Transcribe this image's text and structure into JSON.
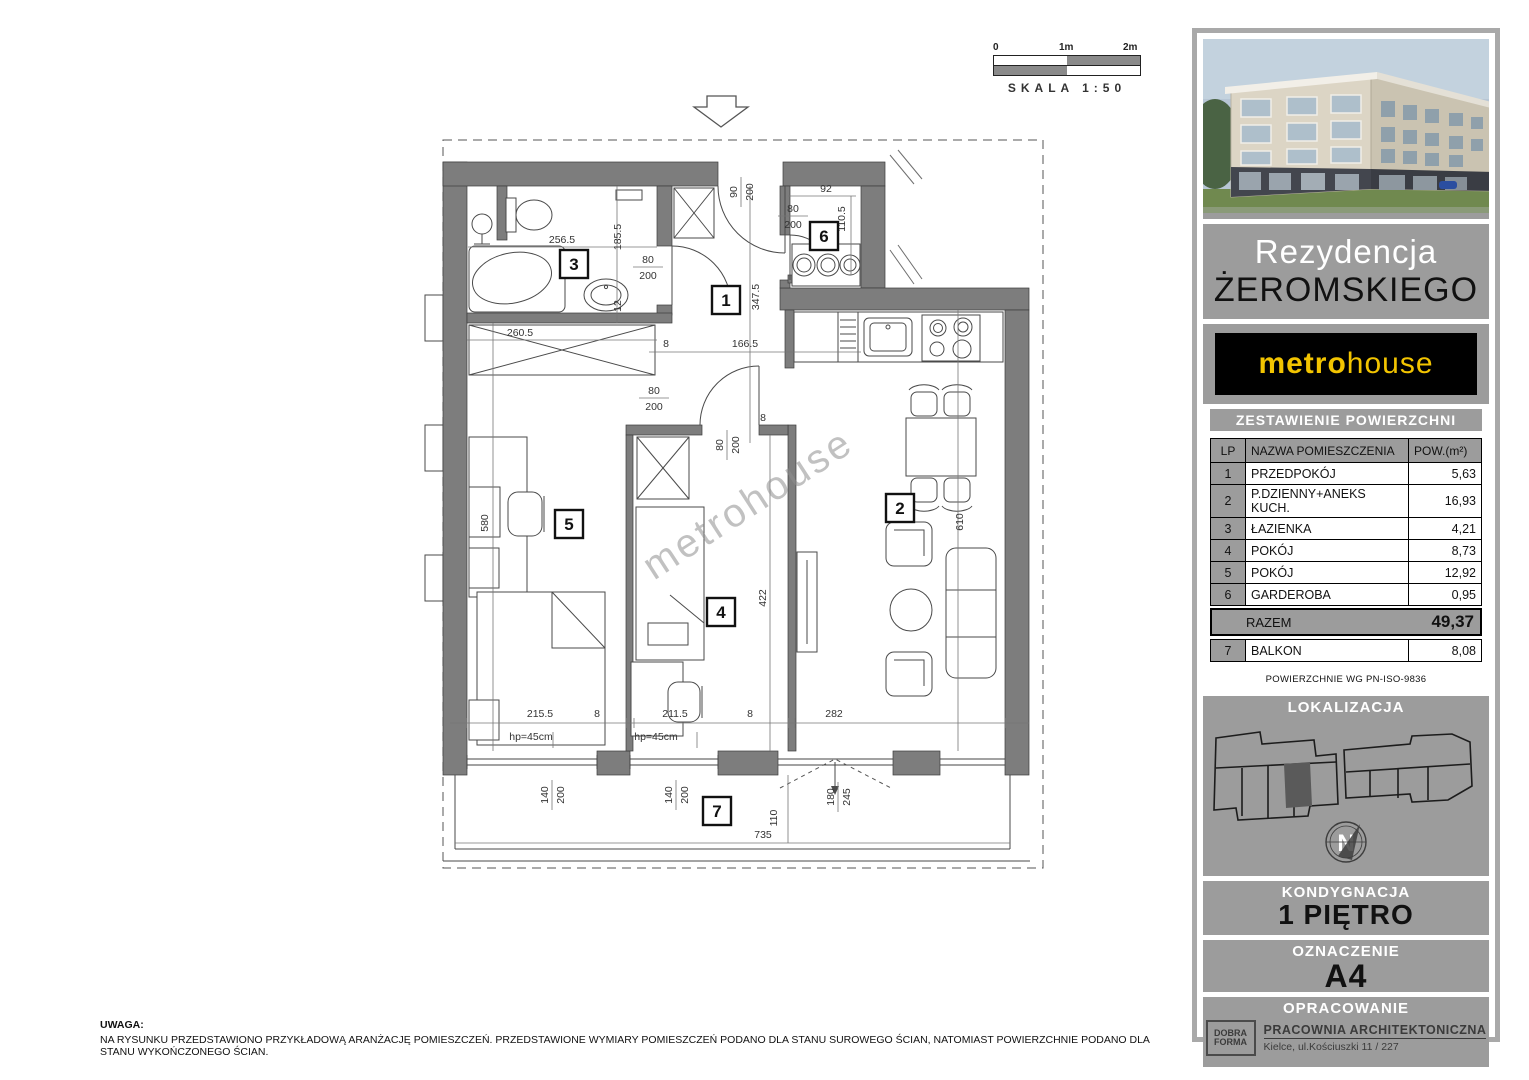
{
  "scale_bar": {
    "label_0": "0",
    "label_1": "1m",
    "label_2": "2m",
    "caption": "SKALA 1:50"
  },
  "watermark": "metrohouse",
  "note": {
    "title": "UWAGA:",
    "body": "NA RYSUNKU PRZEDSTAWIONO PRZYKŁADOWĄ ARANŻACJĘ POMIESZCZEŃ. PRZEDSTAWIONE WYMIARY POMIESZCZEŃ PODANO DLA STANU SUROWEGO ŚCIAN, NATOMIAST POWIERZCHNIE PODANO DLA STANU WYKOŃCZONEGO ŚCIAN."
  },
  "sidebar": {
    "project": {
      "line1": "Rezydencja",
      "line2": "ŻEROMSKIEGO"
    },
    "brand": {
      "part1": "metro",
      "part2": "house"
    },
    "areas_table": {
      "title": "ZESTAWIENIE POWIERZCHNI",
      "headers": [
        "LP",
        "NAZWA POMIESZCZENIA",
        "POW.(m²)"
      ],
      "rows": [
        [
          "1",
          "PRZEDPOKÓJ",
          "5,63"
        ],
        [
          "2",
          "P.DZIENNY+ANEKS KUCH.",
          "16,93"
        ],
        [
          "3",
          "ŁAZIENKA",
          "4,21"
        ],
        [
          "4",
          "POKÓJ",
          "8,73"
        ],
        [
          "5",
          "POKÓJ",
          "12,92"
        ],
        [
          "6",
          "GARDEROBA",
          "0,95"
        ]
      ],
      "total_label": "RAZEM",
      "total_value": "49,37",
      "balkon_row": {
        "lp": "7",
        "name": "BALKON",
        "value": "8,08"
      },
      "footnote": "POWIERZCHNIE WG PN-ISO-9836"
    },
    "location": {
      "title": "LOKALIZACJA",
      "compass_letter": "N"
    },
    "floor": {
      "title": "KONDYGNACJA",
      "value": "1 PIĘTRO"
    },
    "unit": {
      "title": "OZNACZENIE",
      "value": "A4"
    },
    "author": {
      "title": "OPRACOWANIE",
      "logo_line1": "DOBRA",
      "logo_line2": "FORMA",
      "studio": "PRACOWNIA ARCHITEKTONICZNA",
      "address": "Kielce,   ul.Kościuszki 11 / 227"
    }
  },
  "plan": {
    "rooms": [
      {
        "n": "1",
        "x": 726,
        "y": 300
      },
      {
        "n": "2",
        "x": 900,
        "y": 508
      },
      {
        "n": "3",
        "x": 574,
        "y": 264
      },
      {
        "n": "4",
        "x": 721,
        "y": 612
      },
      {
        "n": "5",
        "x": 569,
        "y": 524
      },
      {
        "n": "6",
        "x": 824,
        "y": 236
      },
      {
        "n": "7",
        "x": 717,
        "y": 811
      }
    ],
    "dimensions": [
      {
        "t": "256.5",
        "x": 562,
        "y": 243
      },
      {
        "t": "185.5",
        "x": 621,
        "y": 237,
        "r": -90
      },
      {
        "t": "12",
        "x": 621,
        "y": 306,
        "r": -90
      },
      {
        "t": "260.5",
        "x": 520,
        "y": 336
      },
      {
        "t": "580",
        "x": 488,
        "y": 523,
        "r": -90
      },
      {
        "t": "347.5",
        "x": 759,
        "y": 297,
        "r": -90
      },
      {
        "t": "8",
        "x": 666,
        "y": 347
      },
      {
        "t": "166.5",
        "x": 745,
        "y": 347
      },
      {
        "t": "92",
        "x": 826,
        "y": 192
      },
      {
        "t": "110.5",
        "x": 845,
        "y": 219,
        "r": -90
      },
      {
        "t": "422",
        "x": 766,
        "y": 598,
        "r": -90
      },
      {
        "t": "610",
        "x": 963,
        "y": 522,
        "r": -90
      },
      {
        "t": "8",
        "x": 763,
        "y": 421
      },
      {
        "t": "215.5",
        "x": 540,
        "y": 717
      },
      {
        "t": "8",
        "x": 597,
        "y": 717
      },
      {
        "t": "211.5",
        "x": 675,
        "y": 717
      },
      {
        "t": "8",
        "x": 750,
        "y": 717
      },
      {
        "t": "282",
        "x": 834,
        "y": 717
      },
      {
        "t": "hp=45cm",
        "x": 531,
        "y": 740
      },
      {
        "t": "hp=45cm",
        "x": 656,
        "y": 740
      },
      {
        "t": "110",
        "x": 777,
        "y": 818,
        "r": -90
      },
      {
        "t": "735",
        "x": 763,
        "y": 838
      }
    ],
    "fractions": [
      {
        "t": [
          "80",
          "200"
        ],
        "x": 648,
        "y": 267
      },
      {
        "t": [
          "90",
          "200"
        ],
        "x": 741,
        "y": 192,
        "r": -90
      },
      {
        "t": [
          "80",
          "200"
        ],
        "x": 654,
        "y": 398
      },
      {
        "t": [
          "80",
          "200"
        ],
        "x": 727,
        "y": 445,
        "r": -90
      },
      {
        "t": [
          "80",
          "200"
        ],
        "x": 793,
        "y": 216
      },
      {
        "t": [
          "140",
          "200"
        ],
        "x": 552,
        "y": 795,
        "r": -90
      },
      {
        "t": [
          "140",
          "200"
        ],
        "x": 676,
        "y": 795,
        "r": -90
      },
      {
        "t": [
          "180",
          "245"
        ],
        "x": 838,
        "y": 797,
        "r": -90
      }
    ]
  }
}
